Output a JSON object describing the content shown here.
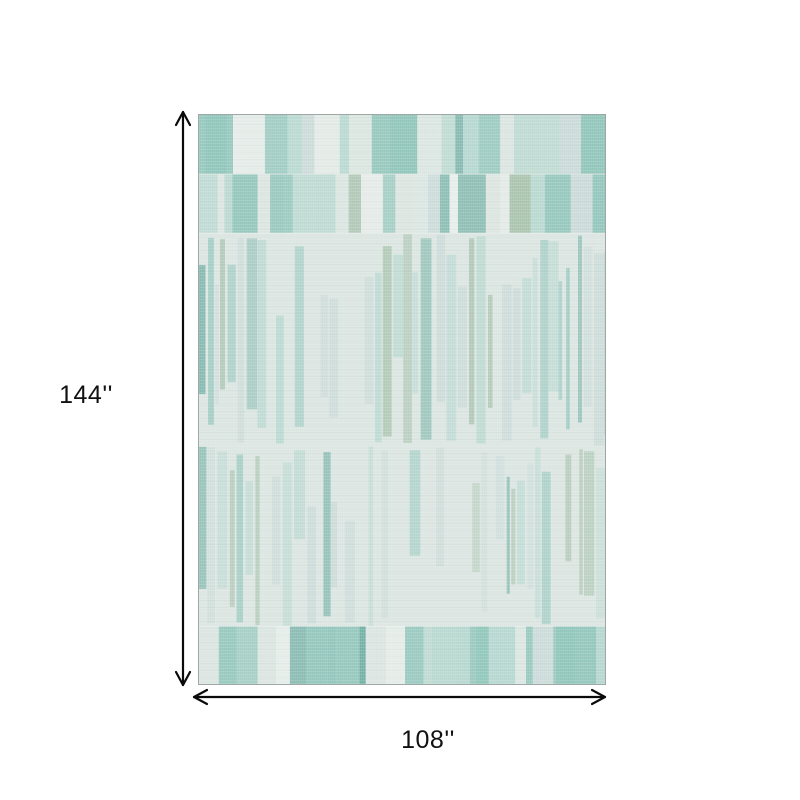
{
  "dimensions": {
    "height_label": "144''",
    "width_label": "108''"
  },
  "colors": {
    "page-bg": "#ffffff",
    "line": "#0a0a0a",
    "label": "#111111",
    "rug-base": "#dbe5e1",
    "rug-border": "#a0a8a5"
  },
  "rug": {
    "width": 406,
    "height": 569,
    "palette": {
      "base": "#dbe5e1",
      "pale": "#e7edea",
      "teal_light": "#b5d7cf",
      "teal_mid": "#8fc5ba",
      "teal_dark": "#74b2a6",
      "sage": "#a9c3ae",
      "blue_gray": "#c8d9d7"
    },
    "bands": [
      {
        "top": 0,
        "height": 59,
        "style": "bold",
        "seed": 7,
        "gap": 0,
        "alpha": 1,
        "weights": [
          [
            "base",
            0.16
          ],
          [
            "pale",
            0.1
          ],
          [
            "teal_light",
            0.22
          ],
          [
            "teal_mid",
            0.22
          ],
          [
            "teal_dark",
            0.12
          ],
          [
            "sage",
            0.1
          ],
          [
            "blue_gray",
            0.08
          ]
        ]
      },
      {
        "top": 59,
        "height": 59,
        "style": "bold",
        "seed": 13,
        "gap": 0,
        "alpha": 1,
        "weights": [
          [
            "base",
            0.18
          ],
          [
            "pale",
            0.1
          ],
          [
            "teal_light",
            0.24
          ],
          [
            "teal_mid",
            0.2
          ],
          [
            "teal_dark",
            0.1
          ],
          [
            "sage",
            0.1
          ],
          [
            "blue_gray",
            0.08
          ]
        ]
      },
      {
        "top": 118,
        "height": 213,
        "style": "fine",
        "seed": 21,
        "gap": 0.32,
        "alpha": 0.9,
        "weights": [
          [
            "teal_light",
            0.28
          ],
          [
            "teal_mid",
            0.16
          ],
          [
            "teal_dark",
            0.09
          ],
          [
            "sage",
            0.17
          ],
          [
            "blue_gray",
            0.3
          ]
        ]
      },
      {
        "top": 331,
        "height": 180,
        "style": "fine",
        "seed": 33,
        "gap": 0.4,
        "alpha": 0.75,
        "weights": [
          [
            "teal_light",
            0.3
          ],
          [
            "teal_mid",
            0.14
          ],
          [
            "teal_dark",
            0.07
          ],
          [
            "sage",
            0.16
          ],
          [
            "blue_gray",
            0.33
          ]
        ]
      },
      {
        "top": 511,
        "height": 58,
        "style": "bold",
        "seed": 47,
        "gap": 0,
        "alpha": 1,
        "weights": [
          [
            "base",
            0.14
          ],
          [
            "pale",
            0.08
          ],
          [
            "teal_light",
            0.24
          ],
          [
            "teal_mid",
            0.24
          ],
          [
            "teal_dark",
            0.12
          ],
          [
            "sage",
            0.1
          ],
          [
            "blue_gray",
            0.08
          ]
        ]
      }
    ],
    "accents": [
      {
        "x": 0,
        "y": 0,
        "w": 34,
        "h": 59,
        "color": "teal_mid",
        "alpha": 0.9
      },
      {
        "x": 357,
        "y": 511,
        "w": 40,
        "h": 58,
        "color": "teal_mid",
        "alpha": 0.95
      }
    ],
    "seams": [
      59,
      118,
      331,
      511
    ]
  }
}
